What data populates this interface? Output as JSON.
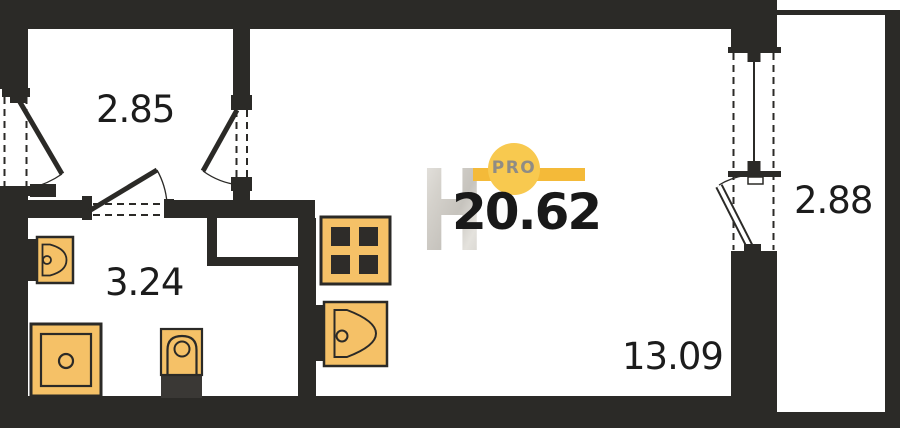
{
  "watermark": {
    "brand_letter": "H",
    "badge": "PRO",
    "total_area": "20.62"
  },
  "rooms": {
    "hallway": {
      "name": "hallway",
      "area": "2.85"
    },
    "bathroom": {
      "name": "bathroom",
      "area": "3.24"
    },
    "living": {
      "name": "living-room",
      "area": "13.09"
    },
    "balcony": {
      "name": "balcony",
      "area": "2.88"
    }
  },
  "fixtures": {
    "bathroom_sink": "bathroom-sink",
    "shower_tray": "shower-tray",
    "toilet": "toilet",
    "stove": "stove",
    "kitchen_sink": "kitchen-sink"
  },
  "palette": {
    "wall": "#2b2a27",
    "fixture_fill": "#f5c167",
    "fixture_outline": "#2b2a27",
    "burner": "#2e2c29",
    "toilet_tank": "#3a3835",
    "accent_bar": "#f4ba39",
    "badge_circle": "#f8c94f",
    "badge_text": "#8f8c85",
    "label_text": "#1c1c1c",
    "background": "#ffffff"
  }
}
